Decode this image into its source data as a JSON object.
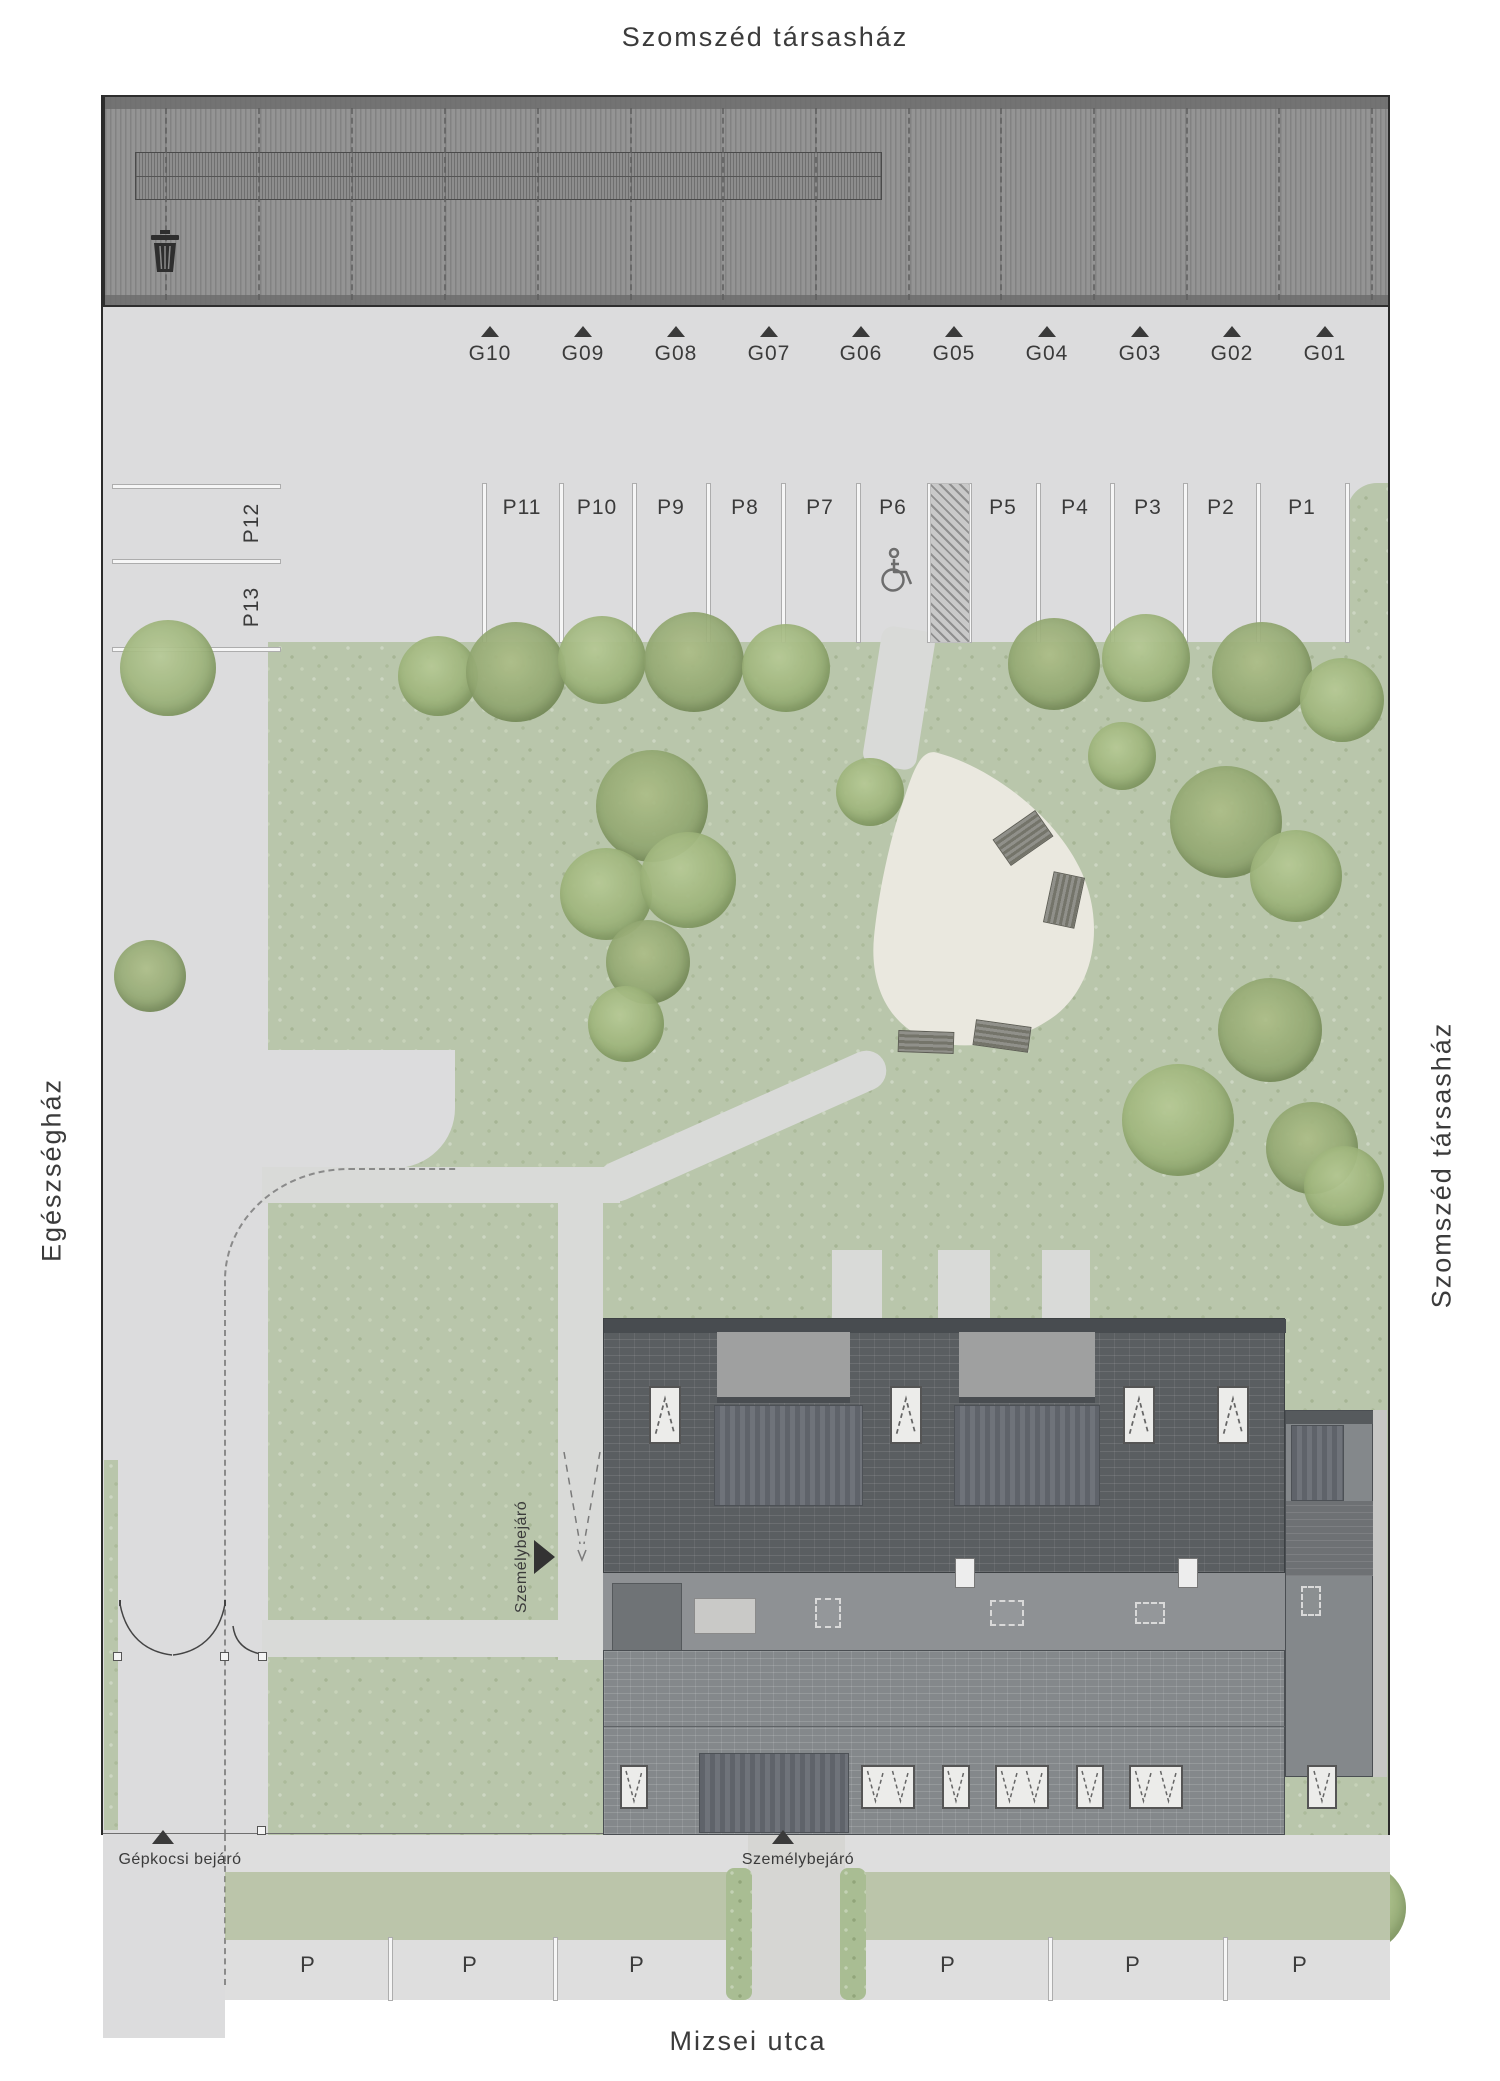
{
  "labels": {
    "top_neighbor": "Szomszéd társasház",
    "right_neighbor": "Szomszéd társasház",
    "left_neighbor": "Egészségház",
    "street": "Mizsei utca",
    "vehicle_entrance": "Gépkocsi bejáró",
    "pedestrian_entrance_street": "Személybejáró",
    "pedestrian_entrance_side": "Személybejáró",
    "street_parking_mark": "P"
  },
  "garages": {
    "stalls": [
      {
        "label": "G10",
        "x": 490
      },
      {
        "label": "G09",
        "x": 583
      },
      {
        "label": "G08",
        "x": 676
      },
      {
        "label": "G07",
        "x": 769
      },
      {
        "label": "G06",
        "x": 861
      },
      {
        "label": "G05",
        "x": 954
      },
      {
        "label": "G04",
        "x": 1047
      },
      {
        "label": "G03",
        "x": 1140
      },
      {
        "label": "G02",
        "x": 1232
      },
      {
        "label": "G01",
        "x": 1325
      }
    ],
    "divider_x": [
      165,
      258,
      351,
      444,
      537,
      630,
      722,
      815,
      908,
      1000,
      1093,
      1186,
      1278,
      1371
    ]
  },
  "parking": {
    "stalls": [
      {
        "label": "P11",
        "x": 522
      },
      {
        "label": "P10",
        "x": 597
      },
      {
        "label": "P9",
        "x": 671
      },
      {
        "label": "P8",
        "x": 745
      },
      {
        "label": "P7",
        "x": 820
      },
      {
        "label": "P6",
        "x": 893,
        "accessible": true
      },
      {
        "label": "P5",
        "x": 1003
      },
      {
        "label": "P4",
        "x": 1075
      },
      {
        "label": "P3",
        "x": 1148
      },
      {
        "label": "P2",
        "x": 1221
      },
      {
        "label": "P1",
        "x": 1302
      }
    ],
    "line_x": [
      484,
      561,
      634,
      708,
      783,
      858,
      929,
      969,
      1038,
      1112,
      1185,
      1258,
      1347
    ],
    "hatch": {
      "x": 931,
      "w": 38
    },
    "accessible_stall": "P6"
  },
  "side_parking": {
    "stalls": [
      {
        "label": "P12",
        "y": 523
      },
      {
        "label": "P13",
        "y": 607
      }
    ],
    "line_y": [
      486,
      561,
      649
    ]
  },
  "street_parking": {
    "label_x": [
      308,
      470,
      637,
      948,
      1133,
      1300
    ],
    "divider_x": [
      390,
      555,
      1050,
      1225
    ]
  },
  "trees": [
    [
      168,
      668,
      48,
      "a"
    ],
    [
      438,
      676,
      40,
      "a"
    ],
    [
      516,
      672,
      50,
      "b"
    ],
    [
      602,
      660,
      44,
      "a"
    ],
    [
      694,
      662,
      50,
      "b"
    ],
    [
      786,
      668,
      44,
      "a"
    ],
    [
      652,
      806,
      56,
      "b"
    ],
    [
      606,
      894,
      46,
      "a"
    ],
    [
      688,
      880,
      48,
      "a"
    ],
    [
      648,
      962,
      42,
      "b"
    ],
    [
      626,
      1024,
      38,
      "a"
    ],
    [
      870,
      792,
      34,
      "a"
    ],
    [
      1054,
      664,
      46,
      "b"
    ],
    [
      1146,
      658,
      44,
      "a"
    ],
    [
      1262,
      672,
      50,
      "b"
    ],
    [
      1342,
      700,
      42,
      "a"
    ],
    [
      1226,
      822,
      56,
      "b"
    ],
    [
      1296,
      876,
      46,
      "a"
    ],
    [
      1270,
      1030,
      52,
      "b"
    ],
    [
      1178,
      1120,
      56,
      "a"
    ],
    [
      1312,
      1148,
      46,
      "b"
    ],
    [
      1344,
      1186,
      40,
      "a"
    ],
    [
      1122,
      756,
      34,
      "a"
    ],
    [
      150,
      976,
      36,
      "b"
    ],
    [
      270,
      1902,
      52,
      "a"
    ],
    [
      374,
      1898,
      54,
      "b"
    ],
    [
      478,
      1902,
      52,
      "a"
    ],
    [
      582,
      1898,
      54,
      "b"
    ],
    [
      682,
      1902,
      48,
      "a"
    ],
    [
      888,
      1902,
      50,
      "b"
    ],
    [
      984,
      1898,
      54,
      "a"
    ],
    [
      1084,
      1902,
      52,
      "b"
    ],
    [
      1184,
      1898,
      54,
      "a"
    ],
    [
      1282,
      1902,
      52,
      "b"
    ],
    [
      1362,
      1908,
      44,
      "a"
    ]
  ],
  "benches": [
    {
      "x": 1023,
      "y": 838,
      "w": 52,
      "h": 32,
      "rot": -35
    },
    {
      "x": 1064,
      "y": 900,
      "w": 52,
      "h": 32,
      "rot": -78
    },
    {
      "x": 926,
      "y": 1042,
      "w": 56,
      "h": 22,
      "rot": 2
    },
    {
      "x": 1002,
      "y": 1036,
      "w": 56,
      "h": 26,
      "rot": 8
    }
  ],
  "building": {
    "windows_top": [
      665,
      906,
      1139,
      1233
    ],
    "windows_bottom": [
      {
        "x": 634,
        "w": 28
      },
      {
        "x": 888,
        "w": 54
      },
      {
        "x": 956,
        "w": 28
      },
      {
        "x": 1022,
        "w": 54
      },
      {
        "x": 1090,
        "w": 28
      },
      {
        "x": 1156,
        "w": 54
      },
      {
        "x": 1322,
        "w": 30
      }
    ]
  },
  "colors": {
    "pavement": "#dcdcdd",
    "green": "#b9c6ab",
    "path": "#d9dad8",
    "courtyard": "#eae8df",
    "garage_roof": "#8f8f8f",
    "building_roof": "#5a5e61",
    "text": "#3b3b3b"
  }
}
